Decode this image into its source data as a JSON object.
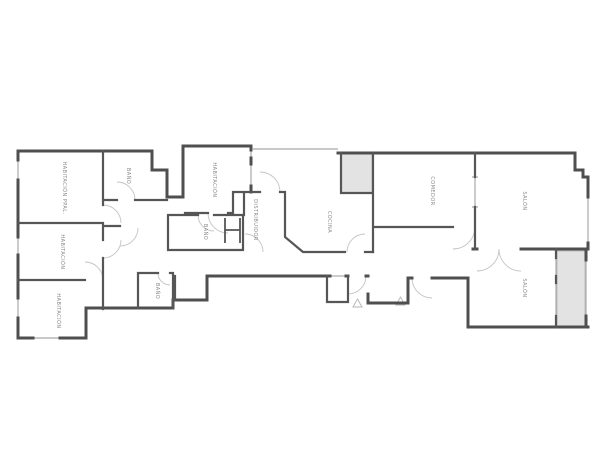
{
  "plan": {
    "title": "floor-plan",
    "rooms": [
      {
        "name": "habitacion-ppal",
        "label": "HABITACIÓN PPAL."
      },
      {
        "name": "bano-1",
        "label": "BAÑO"
      },
      {
        "name": "habitacion-2",
        "label": "HABITACIÓN"
      },
      {
        "name": "habitacion-3",
        "label": "HABITACIÓN"
      },
      {
        "name": "habitacion-4",
        "label": "HABITACIÓN"
      },
      {
        "name": "bano-2",
        "label": "BAÑO"
      },
      {
        "name": "bano-3",
        "label": "BAÑO"
      },
      {
        "name": "distribuidor",
        "label": "DISTRIBUIDOR"
      },
      {
        "name": "cocina",
        "label": "COCINA"
      },
      {
        "name": "comedor",
        "label": "COMEDOR"
      },
      {
        "name": "salon-1",
        "label": "SALÓN"
      },
      {
        "name": "salon-2",
        "label": "SALÓN"
      }
    ],
    "colors": {
      "wall": "#4f4f4f",
      "wall_inner": "#565656",
      "window": "#a9a9a9",
      "door": "#c4c4c4",
      "patio_fill": "#e3e3e3",
      "patio_border": "#bdbdbd",
      "label": "#8a8a8a",
      "background": "#ffffff"
    }
  }
}
